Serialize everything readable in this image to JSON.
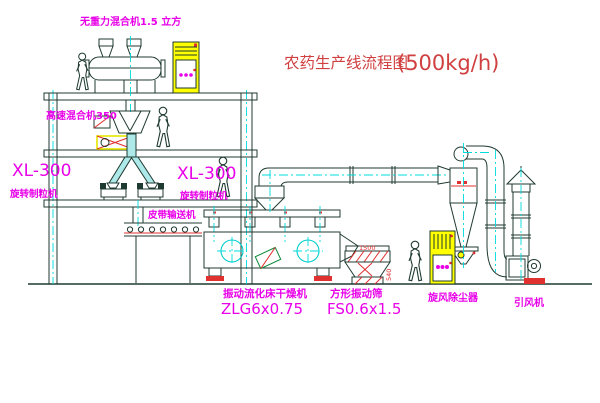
{
  "title": {
    "text": "农药生产线流程图",
    "capacity": "(500kg/h)"
  },
  "labels": {
    "gravity_mixer": "无重力混合机1.5 立方",
    "high_speed_mixer": "高速混合机350",
    "granulator_model_left": "XL-300",
    "granulator_name_left": "旋转制粒机",
    "granulator_model_mid": "XL-300",
    "granulator_name_mid": "旋转制粒机",
    "belt_conveyor": "皮带输送机",
    "dryer_name": "振动流化床干燥机",
    "dryer_model": "ZLG6x0.75",
    "screen_name": "方形振动筛",
    "screen_model": "FS0.6x1.5",
    "cyclone": "旋风除尘器",
    "fan": "引风机"
  },
  "dimensions": {
    "screen_top": "1500",
    "screen_side": "540"
  },
  "colors": {
    "line": "#1f3a31",
    "centerline_cyan": "#00dcdc",
    "label_magenta": "#e800e8",
    "title_red": "#d04040",
    "detail_red": "#e03030",
    "cabinet_yellow": "#ffff00"
  }
}
